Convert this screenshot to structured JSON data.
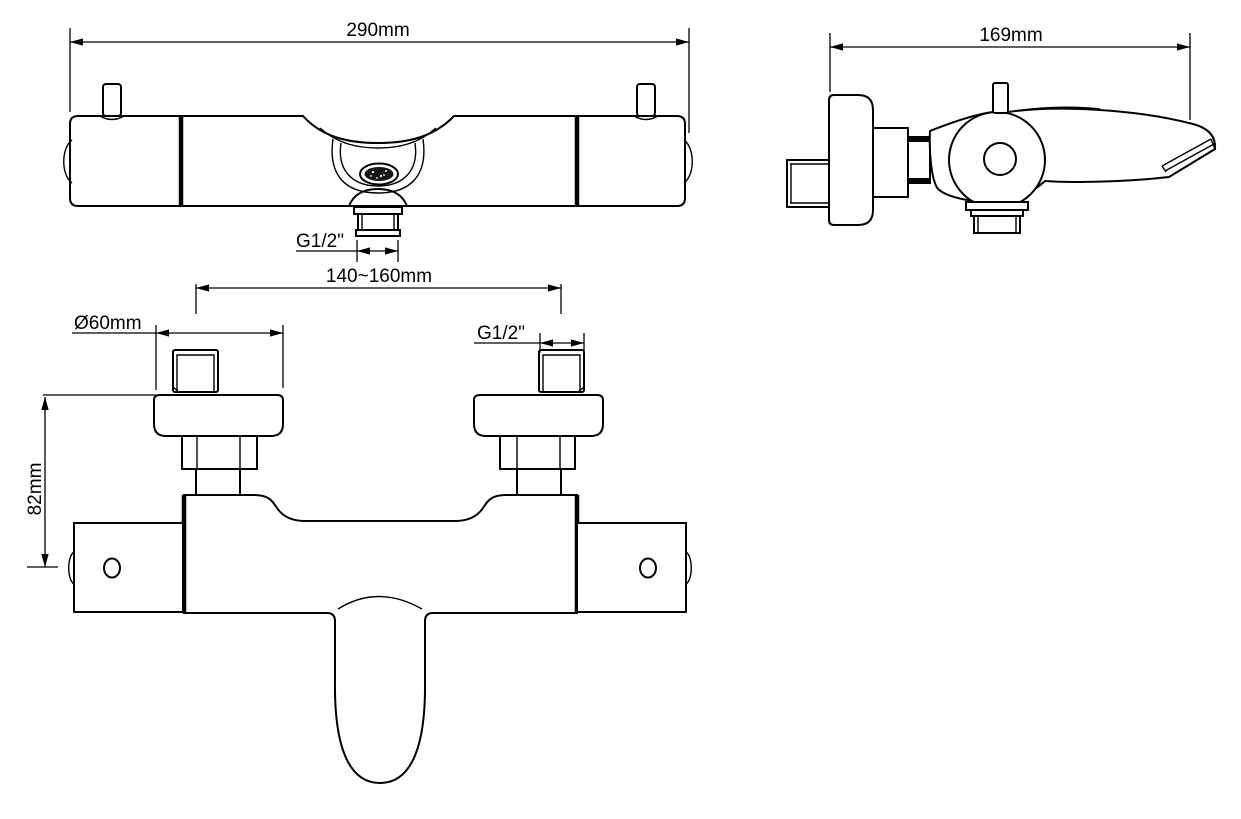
{
  "page": {
    "background": "#ffffff",
    "line_color": "#000000"
  },
  "views": {
    "front": {
      "dim_overall_width": "290mm",
      "dim_outlet_thread": "G1/2\""
    },
    "side": {
      "dim_overall_depth": "169mm"
    },
    "plan": {
      "dim_inlet_centers": "140~160mm",
      "dim_escutcheon_diameter": "Ø60mm",
      "dim_inlet_thread": "G1/2\"",
      "dim_mount_height": "82mm"
    }
  }
}
